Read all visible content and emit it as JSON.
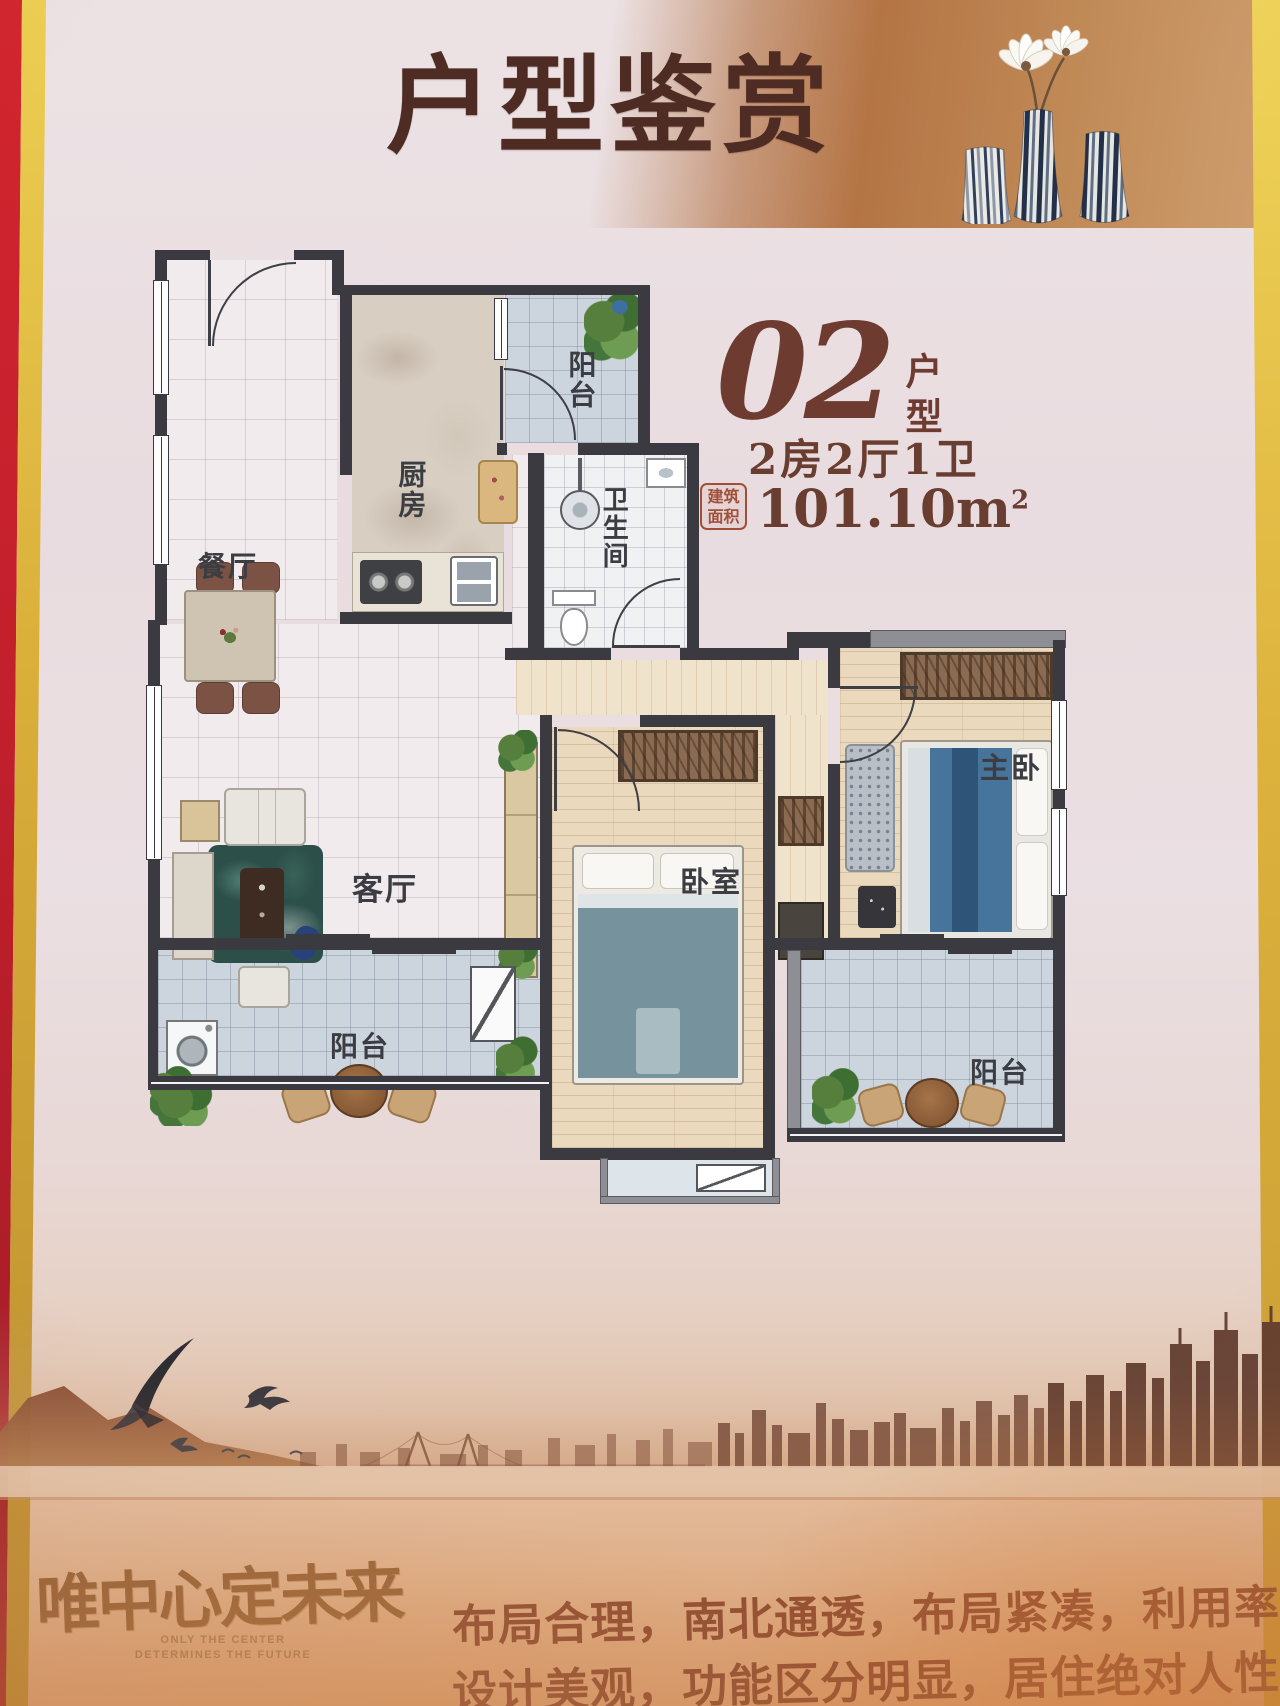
{
  "header": {
    "title": "户型鉴赏"
  },
  "unit_info": {
    "number": "02",
    "suffix": "户型",
    "layout": "2房2厅1卫",
    "seal_top": "建筑",
    "seal_bottom": "面积",
    "area": "101.10m",
    "area_superscript": "2"
  },
  "floorplan": {
    "rooms": [
      {
        "id": "balcony-north",
        "label": "阳台"
      },
      {
        "id": "kitchen",
        "label": "厨房"
      },
      {
        "id": "bathroom",
        "label": "卫生间"
      },
      {
        "id": "dining",
        "label": "餐厅"
      },
      {
        "id": "living",
        "label": "客厅"
      },
      {
        "id": "bedroom",
        "label": "卧室"
      },
      {
        "id": "master-bedroom",
        "label": "主卧"
      },
      {
        "id": "balcony-southwest",
        "label": "阳台"
      },
      {
        "id": "balcony-southeast",
        "label": "阳台"
      }
    ]
  },
  "footer": {
    "calligraphy": "唯中心定未来",
    "english_line1": "ONLY THE CENTER",
    "english_line2": "DETERMINES THE FUTURE",
    "marketing_lines": [
      "布局合理，南北通透，布局紧凑，利用率高；",
      "设计美观，功能区分明显，居住绝对人性化；"
    ]
  },
  "colors": {
    "title_brown": "#4e2c23",
    "accent_brown": "#6e3b31",
    "seal_red": "#a14f39",
    "wall": "#3a3a40",
    "frame_red": "#c8242e",
    "frame_gold": "#dfb93f",
    "marketing_text": "#7c3b2b"
  }
}
